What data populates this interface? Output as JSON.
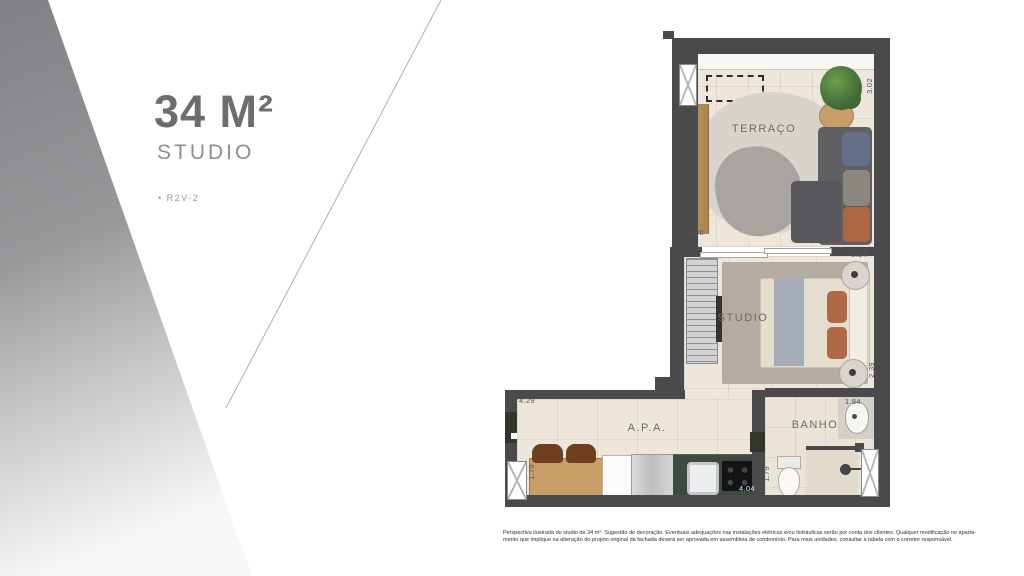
{
  "title_panel": {
    "area": "34 M²",
    "type": "STUDIO",
    "unit": "• R2V-2"
  },
  "floorplan": {
    "rooms": {
      "terraco": "TERRAÇO",
      "studio": "STUDIO",
      "apa": "A.P.A.",
      "banho": "BANHO"
    },
    "dims": {
      "terraco_width": "3.02",
      "terraco_side": "3.30",
      "studio_width": "3.34",
      "studio_side": "2.39",
      "apa_width": "4.29",
      "apa_side": "1.79",
      "kitchen_width": "4.04",
      "banho_width": "1.84",
      "banho_side": "1.79"
    }
  },
  "disclaimer": {
    "line1": "Perspectiva ilustrada do studio de 34 m². Sugestão de decoração. Eventuais adequações nas instalações elétricas e/ou hidráulicas serão por conta dos clientes. Qualquer modificação no aparta-",
    "line2": "mento que implique na alteração do projeto original da fachada deverá ser aprovada em assembleia de condomínio. Para mais unidades, consultar a tabela com o corretor responsável."
  },
  "colors": {
    "wall": "#4a4a4d",
    "floor": "#ece6db",
    "counter": "#3e4940",
    "wood": "#c79f66",
    "sofa": "#606064",
    "pillow_rust": "#b06946",
    "pillow_blue": "#666f88",
    "plant": "#47723a",
    "wedge_gray": "#88888c",
    "title_gray": "#6d6d71"
  }
}
